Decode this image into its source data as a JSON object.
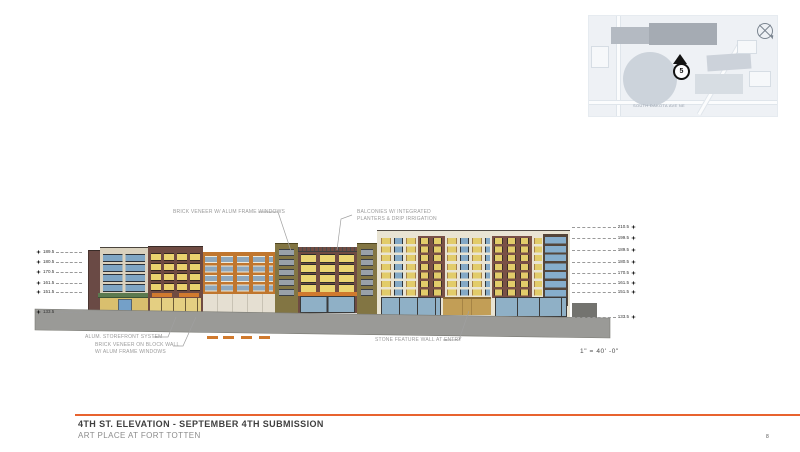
{
  "map": {
    "marker_label": "5",
    "street_label": "SOUTH DAKOTA AVE NE"
  },
  "drawing": {
    "annotations": {
      "brick_veneer_top": "BRICK VENEER W/ ALUM FRAME WINDOWS",
      "balconies": "BALCONIES W/ INTEGRATED PLANTERS & DRIP IRRIGATION",
      "storefront": "ALUM. STOREFRONT SYSTEM",
      "brick_veneer_block": "BRICK VENEER ON BLOCK WALL W/ ALUM FRAME WINDOWS",
      "stone_wall": "STONE FEATURE WALL AT ENTRY"
    },
    "scale_note": "1\" = 40' -0\"",
    "elevation_markers": {
      "left": [
        "189.5",
        "180.5",
        "170.5",
        "161.5",
        "151.5",
        "133.5"
      ],
      "right": [
        "210.5",
        "199.5",
        "189.5",
        "180.5",
        "170.5",
        "161.5",
        "151.5",
        "133.5"
      ]
    }
  },
  "title_block": {
    "title": "4TH ST. ELEVATION - SEPTEMBER 4TH SUBMISSION",
    "subtitle": "ART PLACE AT FORT TOTTEN",
    "page_number": "8"
  },
  "colors": {
    "accent_orange": "#E8632F",
    "brick_maroon": "#6F4B42",
    "brick_orange": "#C0762E",
    "cream_facade": "#E9E4D3",
    "olive_facade": "#827543",
    "glass_blue": "#84A9C6",
    "window_yellow": "#E2CC6A",
    "awning_green": "#5C7A50",
    "awning_orange": "#D07A2E",
    "ground_gray": "#9A9A97"
  }
}
